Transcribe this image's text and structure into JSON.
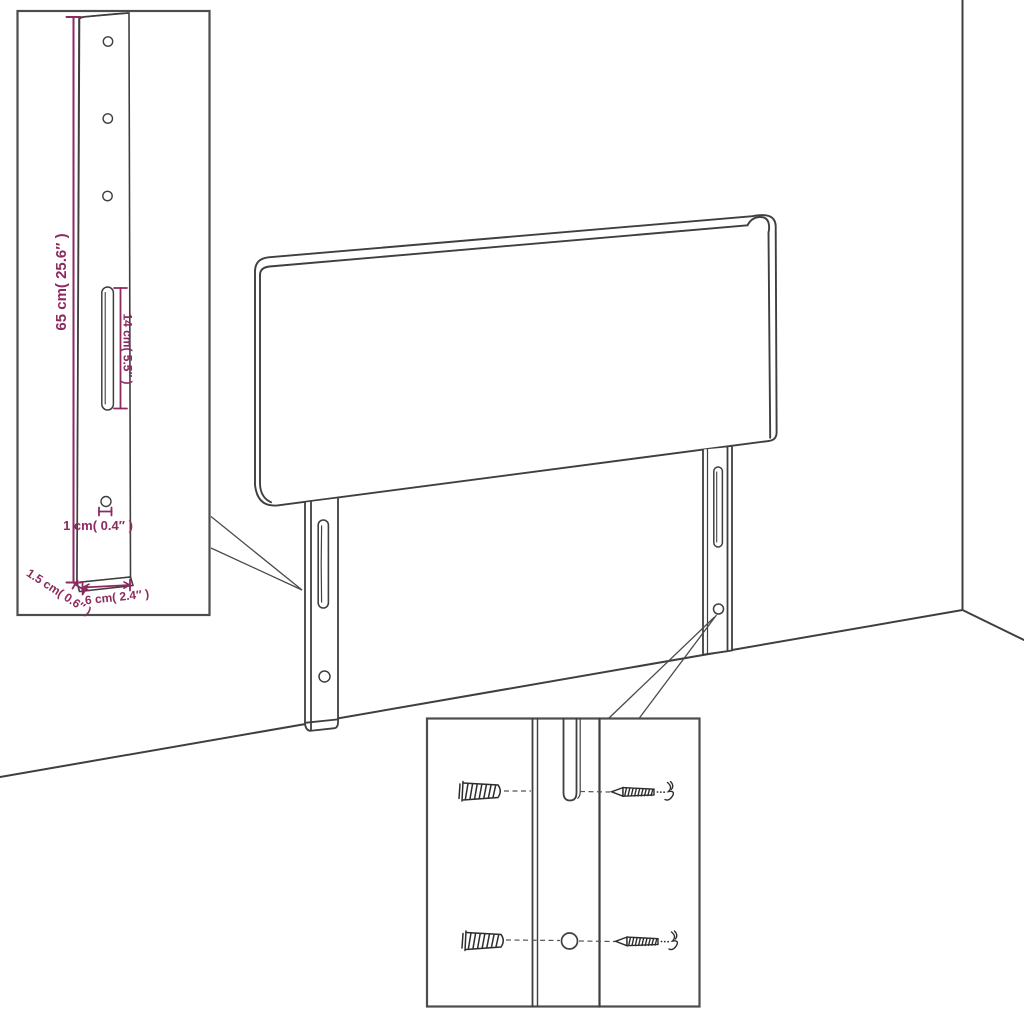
{
  "diagram": {
    "kind": "furniture-assembly-diagram",
    "parts": {
      "panel": "headboard-panel",
      "leg": "mounting-leg",
      "anchor": "wall-plug-icon",
      "fastener": "screw-icon"
    }
  },
  "dimensions": {
    "height_label": "65 cm( 25.6″ )",
    "slot_label": "14 cm( 5.5″ )",
    "hole_label": "1 cm( 0.4″ )",
    "thickness_label": "1.5 cm( 0.6″ )",
    "width_label": "6 cm( 2.4″ )"
  },
  "colors": {
    "background": "#ffffff",
    "line": "#3f3f3f",
    "inset_border": "#4d4d4d",
    "dimension": "#8d2a60"
  }
}
